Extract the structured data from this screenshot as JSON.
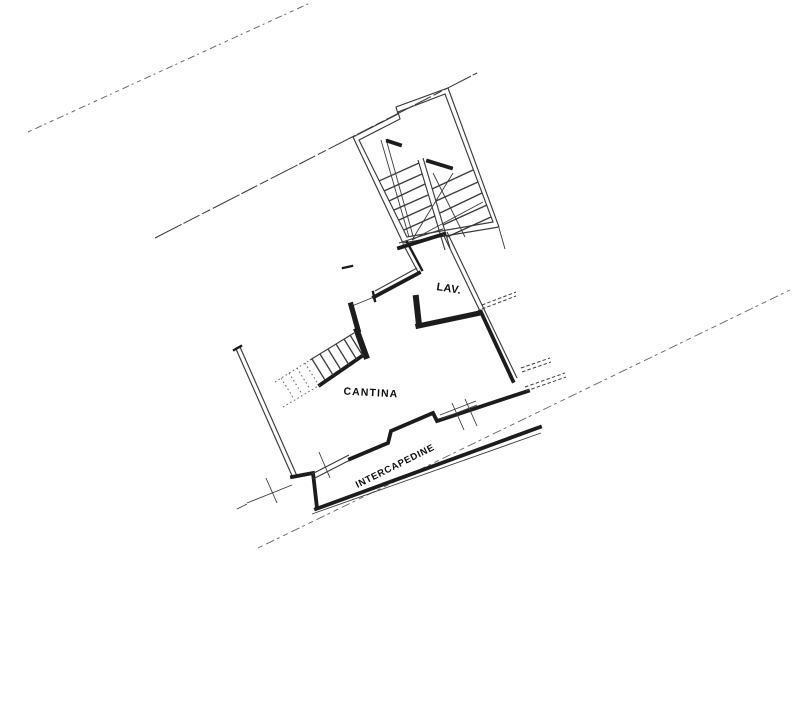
{
  "drawing": {
    "kind": "scanned basement floor plan",
    "labels": {
      "lav": "LAV.",
      "cantina": "CANTINA",
      "intercapedine": "INTERCAPEDINE"
    },
    "colors": {
      "background": "#ffffff",
      "ink": "#1c1c1c",
      "thin_line": "#3a3a3a",
      "faint_line": "#6a6a6a"
    }
  }
}
